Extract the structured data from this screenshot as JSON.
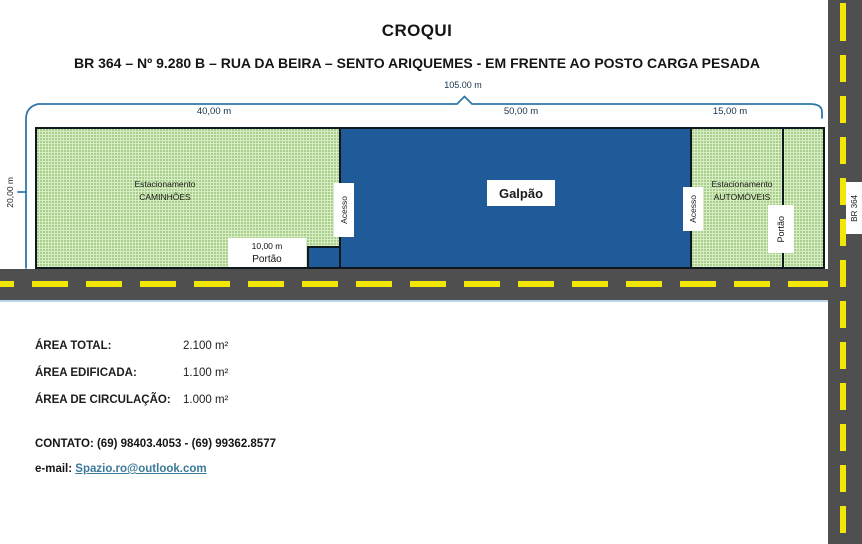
{
  "title": "CROQUI",
  "subtitle": "BR 364 – Nº 9.280 B – RUA DA BEIRA – SENTO ARIQUEMES - EM FRENTE AO POSTO CARGA PESADA",
  "plan": {
    "total_width": "105.00 m",
    "left_height": "20,00 m",
    "truck_parking": {
      "width": "40,00 m",
      "line1": "Estacionamento",
      "line2": "CAMINHÕES"
    },
    "warehouse": {
      "width": "50,00 m",
      "label": "Galpão"
    },
    "car_parking": {
      "width": "15,00 m",
      "line1": "Estacionamento",
      "line2": "AUTOMÓVEIS"
    },
    "access_left": "Acesso",
    "access_right": "Acesso",
    "bottom_gate": {
      "width": "10,00 m",
      "label": "Portão"
    },
    "right_gate": "Portão",
    "highway": "BR 364"
  },
  "areas": {
    "rows": [
      {
        "label": "ÁREA TOTAL:",
        "value": "2.100 m²"
      },
      {
        "label": "ÁREA EDIFICADA:",
        "value": "1.100 m²"
      },
      {
        "label": "ÁREA DE CIRCULAÇÃO:",
        "value": "1.000 m²"
      }
    ]
  },
  "contact": {
    "phones": "CONTATO: (69) 98403.4053   -  (69) 99362.8577",
    "email_label": "e-mail:",
    "email": "Spazio.ro@outlook.com"
  },
  "colors": {
    "parking_green": "#d9edc5",
    "parking_dot": "#a3cc85",
    "warehouse_blue": "#1f5b99",
    "road_gray": "#4f4f4f",
    "lane_yellow": "#f2e607",
    "dimension_blue": "#2e78ab",
    "outline_dark": "#10181f",
    "link_teal": "#3b7a99"
  }
}
